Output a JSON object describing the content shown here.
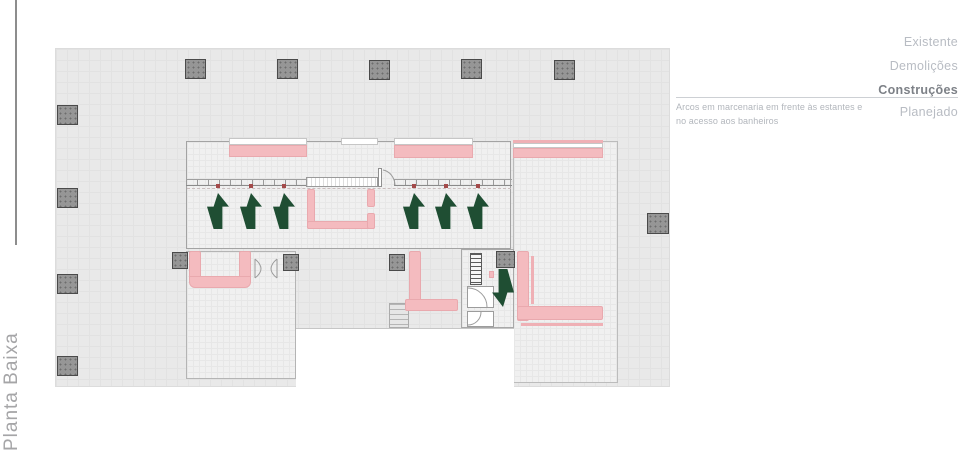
{
  "page": {
    "vertical_title": "Planta Baixa"
  },
  "legend": {
    "items": [
      {
        "label": "Existente",
        "active": false
      },
      {
        "label": "Demolições",
        "active": false
      },
      {
        "label": "Construções",
        "active": true
      },
      {
        "label": "Planejado",
        "active": false
      }
    ],
    "note": "Arcos em marcenaria em frente às estantes e no acesso aos banheiros"
  },
  "plan": {
    "type": "floor-plan",
    "highlighted_layer": "Construções",
    "up_arrows_count": 6,
    "down_arrows_count": 1,
    "columns_count": 14,
    "colors": {
      "construction_pink": "#f4bbbf",
      "construction_pink_border": "#e9a9ae",
      "arrow_green": "#1f4e33",
      "column_gray": "#969696",
      "canvas_gray": "#e9e9e9",
      "legend_text": "#b8bcc3",
      "legend_text_active": "#7d8187"
    }
  }
}
